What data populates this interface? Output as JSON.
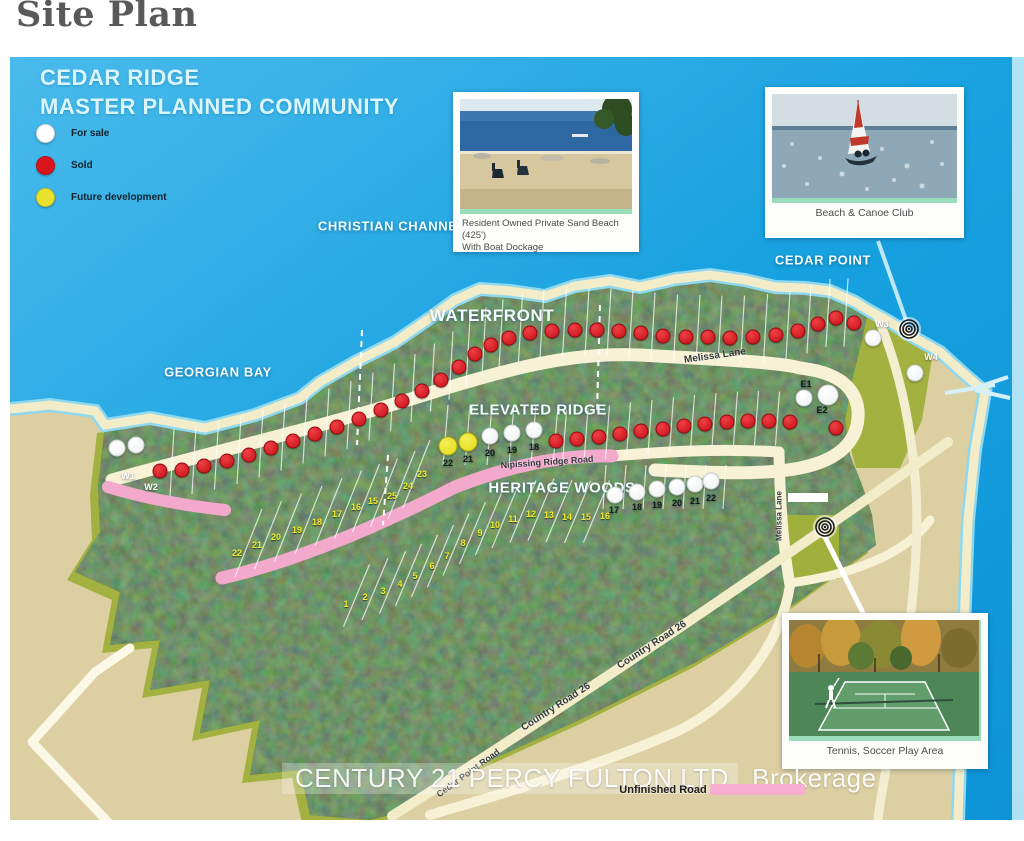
{
  "page": {
    "title": "Site Plan"
  },
  "map": {
    "heading": {
      "line1": "CEDAR RIDGE",
      "line2": "MASTER PLANNED COMMUNITY"
    },
    "legend_items": [
      {
        "label": "For sale",
        "color": "#ffffff"
      },
      {
        "label": "Sold",
        "color": "#d8151c"
      },
      {
        "label": "Future development",
        "color": "#e9e22c"
      }
    ],
    "water_color": "#1aa3e0",
    "area_labels": [
      {
        "text": "CHRISTIAN CHANNEL",
        "x": 382,
        "y": 169,
        "size": 13
      },
      {
        "text": "GEORGIAN BAY",
        "x": 208,
        "y": 315,
        "size": 13
      },
      {
        "text": "WATERFRONT",
        "x": 482,
        "y": 259,
        "size": 17
      },
      {
        "text": "ELEVATED RIDGE",
        "x": 528,
        "y": 353,
        "size": 15
      },
      {
        "text": "HERITAGE WOODS",
        "x": 552,
        "y": 431,
        "size": 15
      },
      {
        "text": "CEDAR POINT",
        "x": 813,
        "y": 203,
        "size": 13
      }
    ],
    "road_labels": [
      {
        "text": "Melissa Lane",
        "x": 705,
        "y": 299,
        "rot": -8,
        "size": 10
      },
      {
        "text": "Melissa Lane",
        "x": 769,
        "y": 459,
        "rot": -90,
        "size": 8
      },
      {
        "text": "Nipissing Ridge Road",
        "x": 537,
        "y": 405,
        "rot": -4,
        "size": 9
      },
      {
        "text": "Country Road 26",
        "x": 642,
        "y": 588,
        "rot": -33,
        "size": 10
      },
      {
        "text": "Country Road 26",
        "x": 546,
        "y": 650,
        "rot": -33,
        "size": 10
      },
      {
        "text": "Cedar Point Road",
        "x": 458,
        "y": 716,
        "rot": -36,
        "size": 9
      }
    ],
    "markers": {
      "sold_waterfront": [
        [
          150,
          414
        ],
        [
          172,
          413
        ],
        [
          194,
          409
        ],
        [
          217,
          404
        ],
        [
          239,
          398
        ],
        [
          261,
          391
        ],
        [
          283,
          384
        ],
        [
          305,
          377
        ],
        [
          327,
          370
        ],
        [
          349,
          362
        ],
        [
          371,
          353
        ],
        [
          392,
          344
        ],
        [
          412,
          334
        ],
        [
          431,
          323
        ],
        [
          449,
          310
        ],
        [
          465,
          297
        ],
        [
          481,
          288
        ],
        [
          499,
          281
        ],
        [
          520,
          276
        ],
        [
          542,
          274
        ],
        [
          565,
          273
        ],
        [
          587,
          273
        ],
        [
          609,
          274
        ],
        [
          631,
          276
        ],
        [
          653,
          279
        ],
        [
          676,
          280
        ],
        [
          698,
          280
        ],
        [
          720,
          281
        ],
        [
          743,
          280
        ],
        [
          766,
          278
        ],
        [
          788,
          274
        ],
        [
          808,
          267
        ],
        [
          826,
          261
        ],
        [
          844,
          266
        ]
      ],
      "sold_ridge": [
        [
          546,
          384
        ],
        [
          567,
          382
        ],
        [
          589,
          380
        ],
        [
          610,
          377
        ],
        [
          631,
          374
        ],
        [
          653,
          372
        ],
        [
          674,
          369
        ],
        [
          695,
          367
        ],
        [
          717,
          365
        ],
        [
          738,
          364
        ],
        [
          759,
          364
        ],
        [
          780,
          365
        ],
        [
          826,
          371
        ]
      ],
      "for_sale": [
        {
          "x": 107,
          "y": 391,
          "label": "W1",
          "lx": 118,
          "ly": 419,
          "lc": "#ffffff"
        },
        {
          "x": 126,
          "y": 388,
          "label": "W2",
          "lx": 141,
          "ly": 430,
          "lc": "#ffffff"
        },
        {
          "x": 863,
          "y": 281,
          "label": "W3",
          "lx": 872,
          "ly": 267,
          "lc": "#ffffff"
        },
        {
          "x": 905,
          "y": 316,
          "label": "W4",
          "lx": 921,
          "ly": 300,
          "lc": "#ffffff"
        },
        {
          "x": 794,
          "y": 341,
          "label": "E1",
          "lx": 796,
          "ly": 327,
          "lc": "#101820"
        },
        {
          "x": 818,
          "y": 338,
          "label": "E2",
          "lx": 812,
          "ly": 353,
          "lc": "#101820",
          "big": true
        },
        {
          "x": 480,
          "y": 379,
          "label": "20",
          "lx": 480,
          "ly": 396,
          "lc": "#101820"
        },
        {
          "x": 502,
          "y": 376,
          "label": "19",
          "lx": 502,
          "ly": 393,
          "lc": "#101820"
        },
        {
          "x": 524,
          "y": 373,
          "label": "18",
          "lx": 524,
          "ly": 390,
          "lc": "#101820"
        },
        {
          "x": 605,
          "y": 438,
          "label": "17",
          "lx": 604,
          "ly": 453,
          "lc": "#101820"
        },
        {
          "x": 627,
          "y": 435,
          "label": "18",
          "lx": 627,
          "ly": 450,
          "lc": "#101820"
        },
        {
          "x": 647,
          "y": 432,
          "label": "19",
          "lx": 647,
          "ly": 448,
          "lc": "#101820"
        },
        {
          "x": 667,
          "y": 430,
          "label": "20",
          "lx": 667,
          "ly": 446,
          "lc": "#101820"
        },
        {
          "x": 685,
          "y": 427,
          "label": "21",
          "lx": 685,
          "ly": 444,
          "lc": "#101820"
        },
        {
          "x": 701,
          "y": 424,
          "label": "22",
          "lx": 701,
          "ly": 441,
          "lc": "#101820"
        }
      ],
      "future": [
        {
          "x": 438,
          "y": 389,
          "label": "22",
          "lx": 438,
          "ly": 406,
          "lc": "#101820"
        },
        {
          "x": 458,
          "y": 385,
          "label": "21",
          "lx": 458,
          "ly": 402,
          "lc": "#101820"
        }
      ]
    },
    "lot_numbers": {
      "upper": [
        {
          "n": "22",
          "x": 227,
          "y": 496
        },
        {
          "n": "21",
          "x": 247,
          "y": 488
        },
        {
          "n": "20",
          "x": 266,
          "y": 480
        },
        {
          "n": "19",
          "x": 287,
          "y": 473
        },
        {
          "n": "18",
          "x": 307,
          "y": 465
        },
        {
          "n": "17",
          "x": 327,
          "y": 457
        },
        {
          "n": "16",
          "x": 346,
          "y": 450
        },
        {
          "n": "15",
          "x": 363,
          "y": 444
        },
        {
          "n": "25",
          "x": 382,
          "y": 439
        },
        {
          "n": "24",
          "x": 398,
          "y": 429
        },
        {
          "n": "23",
          "x": 412,
          "y": 417
        }
      ],
      "lower": [
        {
          "n": "1",
          "x": 336,
          "y": 547
        },
        {
          "n": "2",
          "x": 355,
          "y": 540
        },
        {
          "n": "3",
          "x": 373,
          "y": 534
        },
        {
          "n": "4",
          "x": 390,
          "y": 527
        },
        {
          "n": "5",
          "x": 405,
          "y": 519
        },
        {
          "n": "6",
          "x": 422,
          "y": 509
        },
        {
          "n": "7",
          "x": 437,
          "y": 499
        },
        {
          "n": "8",
          "x": 453,
          "y": 486
        },
        {
          "n": "9",
          "x": 470,
          "y": 476
        },
        {
          "n": "10",
          "x": 485,
          "y": 468
        },
        {
          "n": "11",
          "x": 503,
          "y": 462
        },
        {
          "n": "12",
          "x": 521,
          "y": 457
        },
        {
          "n": "13",
          "x": 539,
          "y": 458
        },
        {
          "n": "14",
          "x": 557,
          "y": 460
        },
        {
          "n": "15",
          "x": 576,
          "y": 460
        },
        {
          "n": "16",
          "x": 595,
          "y": 459
        }
      ]
    },
    "poi_markers": [
      {
        "x": 899,
        "y": 272
      },
      {
        "x": 815,
        "y": 470
      }
    ],
    "cards": [
      {
        "id": "beach",
        "caption": [
          "Resident Owned Private Sand Beach (425')",
          "With Boat Dockage"
        ]
      },
      {
        "id": "canoe",
        "caption": [
          "Beach & Canoe Club"
        ]
      },
      {
        "id": "tennis",
        "caption": [
          "Tennis, Soccer Play Area"
        ]
      }
    ],
    "watermark": "CENTURY 21 PERCY FULTON LTD., Brokerage",
    "unfinished_road_label": "Unfinished Road"
  }
}
